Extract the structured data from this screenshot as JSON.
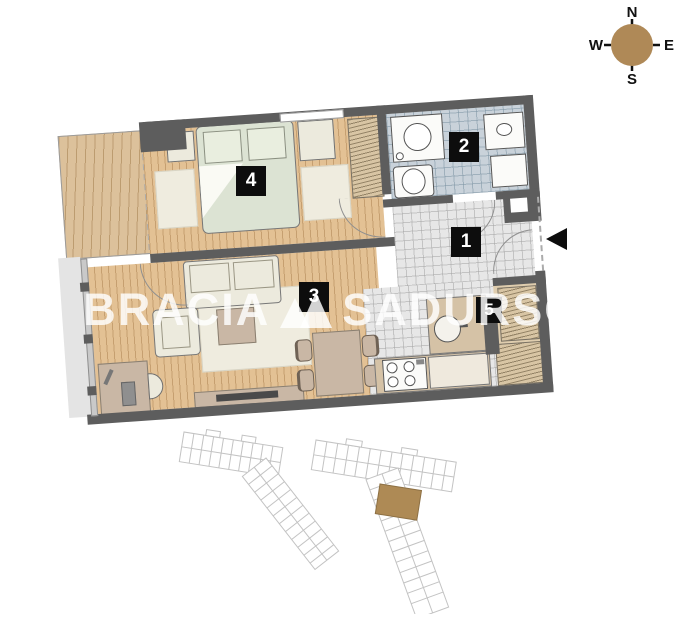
{
  "compass": {
    "n": "N",
    "e": "E",
    "s": "S",
    "w": "W",
    "circle_color": "#af8957"
  },
  "rooms": [
    {
      "number": "1"
    },
    {
      "number": "2"
    },
    {
      "number": "3"
    },
    {
      "number": "4"
    },
    {
      "number": "5"
    }
  ],
  "watermark": {
    "left": "BRACIA",
    "right": "SADURSCY",
    "color": "rgba(255,255,255,0.82)"
  },
  "plan_colors": {
    "wall": "#5d5d5d",
    "wood_floor": "#e3c194",
    "balcony_floor": "#dcc19b",
    "bathroom_tile": "#c9d2da",
    "hall_tile": "#e7e7e7",
    "bed": "#dce3d3",
    "furniture_cream": "#eceadd",
    "furniture_taupe": "#c9b7a5",
    "wardrobe_hatch": "#d8c5a4",
    "label_background": "#0d0d0d"
  },
  "minimap": {
    "outline_color": "#c3c3c3",
    "highlight_color": "#ae8a55"
  }
}
